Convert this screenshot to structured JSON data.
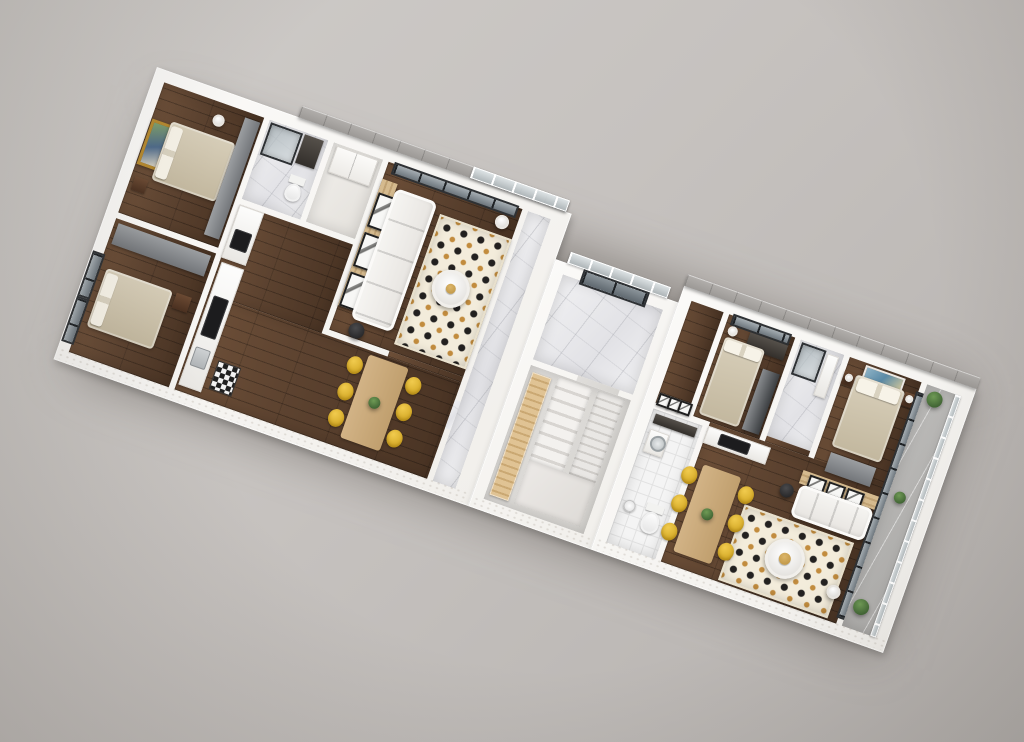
{
  "scene": {
    "type": "3d-floor-plan-render",
    "view": "rotated axonometric top-down",
    "rotation_deg": 19.5,
    "units_count": 2,
    "visible_text": ""
  },
  "palette": {
    "bg1": "#cfccc9",
    "bg2": "#c6c2bf",
    "bg3": "#b5b1ae",
    "wall": "#f1efeb",
    "ledge1": "#b2afac",
    "ledge2": "#9c9996",
    "woodDark1": "#5d4330",
    "woodDark2": "#4a3424",
    "woodDark3": "#6d4f38",
    "woodLight1": "#e0c394",
    "woodLight2": "#caa873",
    "woodTable1": "#d2b386",
    "woodTable2": "#c09f6e",
    "darkWood": "#4a3020",
    "marble1": "#f0f0f2",
    "marble2": "#e2e2e6",
    "tile": "#f4f4f4",
    "tileLine": "#e2e2e2",
    "concrete": "#d6d4d0",
    "stair1": "#f3f1ee",
    "stair2": "#d8d5d1",
    "rugBase": "#f3ecdb",
    "rugDot": "#232120",
    "rugGold": "#c28c3e",
    "sofa1": "#f6f5f2",
    "sofa2": "#e7e4e0",
    "bed1": "#d8cfba",
    "bed2": "#c2b79e",
    "grayFurn1": "#9b9ea1",
    "grayFurn2": "#73767a",
    "darkFurn2": "#3b3e41",
    "glass1": "#8f979c",
    "glass2": "#b9c0c4",
    "frameDark": "#2e3134",
    "yellow1": "#f1cb4e",
    "yellow2": "#d3a825",
    "slat1": "#d5ba8e",
    "slat2": "#c0a274",
    "paintGold": "#b5892f",
    "plant1": "#6f9a55",
    "plant2": "#3f6333",
    "balcony": "#bcbbb9",
    "black": "#1c1c1e"
  },
  "building": {
    "left_unit": {
      "rooms": [
        {
          "name": "bedroom-back",
          "furniture": [
            "double-bed",
            "gray-wardrobe",
            "gold-framed-landscape-painting",
            "pendant-lamp",
            "nightstand"
          ]
        },
        {
          "name": "bedroom-front",
          "furniture": [
            "double-bed",
            "gray-wardrobe",
            "nightstand",
            "floor-to-ceiling-windows"
          ]
        },
        {
          "name": "bathroom",
          "furniture": [
            "glass-shower",
            "dark-vanity",
            "toilet"
          ]
        },
        {
          "name": "closet",
          "furniture": [
            "built-in-white-wardrobe"
          ]
        },
        {
          "name": "kitchen",
          "furniture": [
            "tall-appliance-column",
            "oven",
            "counter-with-cooktop",
            "sink",
            "checkered-floor-mat"
          ]
        },
        {
          "name": "dining-area",
          "furniture": [
            "wood-dining-table",
            "six-yellow-chairs",
            "plant-centerpiece"
          ]
        },
        {
          "name": "living-room",
          "furniture": [
            "wood-slat-accent-wall",
            "three-framed-prints",
            "white-sectional-sofa",
            "polka-dot-rug",
            "round-coffee-table",
            "floor-lamp",
            "black-side-table",
            "panoramic-window"
          ]
        },
        {
          "name": "entry-corridor",
          "furniture": [
            "marble-floor"
          ]
        }
      ]
    },
    "core": {
      "rooms": [
        {
          "name": "entry-hall",
          "furniture": [
            "marble-floor",
            "glass-entry-door",
            "glass-balustrade"
          ]
        },
        {
          "name": "staircase",
          "furniture": [
            "wide-stair-flight",
            "narrow-stair-flight",
            "landing",
            "light-wood-storage-bench"
          ]
        }
      ]
    },
    "right_unit": {
      "rooms": [
        {
          "name": "hallway",
          "furniture": [
            "three-framed-black-and-white-prints"
          ]
        },
        {
          "name": "wc",
          "furniture": [
            "white-tile-floor",
            "black-vanity",
            "washing-machine",
            "toilet",
            "robot-vacuum"
          ]
        },
        {
          "name": "bedroom-second",
          "furniture": [
            "double-bed",
            "dark-wardrobe",
            "vanity-desk",
            "table-lamp",
            "window"
          ]
        },
        {
          "name": "shower-bathroom",
          "furniture": [
            "glass-shower",
            "white-vanity"
          ]
        },
        {
          "name": "master-bedroom",
          "furniture": [
            "double-bed",
            "blue-abstract-painting",
            "two-dark-nightstands",
            "two-wall-lamps",
            "gray-dresser"
          ]
        },
        {
          "name": "living-dining",
          "furniture": [
            "kitchen-counter-with-cooktop",
            "wood-dining-table",
            "six-yellow-chairs",
            "wood-slat-accent-wall",
            "three-framed-prints",
            "white-sofa",
            "polka-dot-rug",
            "round-coffee-table",
            "floor-lamp",
            "black-side-table"
          ]
        },
        {
          "name": "balcony",
          "furniture": [
            "glass-railing",
            "three-potted-plants",
            "stone-floor"
          ]
        }
      ]
    }
  }
}
